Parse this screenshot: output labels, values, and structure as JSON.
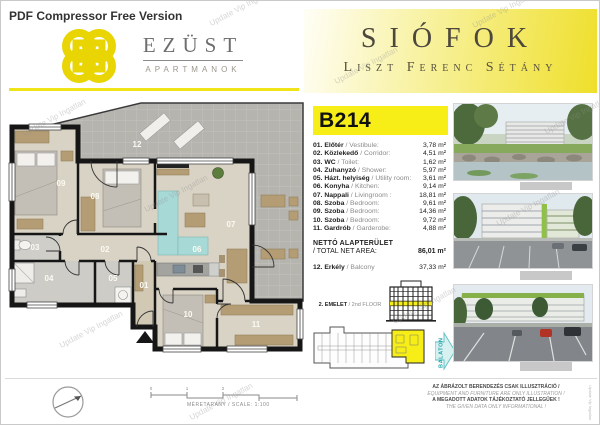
{
  "page": {
    "pdf_banner": "PDF Compressor Free Version",
    "watermark": "Update Vip Ingatlan"
  },
  "brand": {
    "name": "EZÜST",
    "subtitle": "APARTMANOK"
  },
  "location": {
    "city": "SIÓFOK",
    "street": "Liszt Ferenc Sétány"
  },
  "unit": {
    "id": "B214",
    "rooms": [
      {
        "num": "01.",
        "hu": " Előtér",
        "en": " / Vestibule:",
        "area": "3,78 m²"
      },
      {
        "num": "02.",
        "hu": " Közlekedő",
        "en": " / Corridor:",
        "area": "4,51 m²"
      },
      {
        "num": "03.",
        "hu": " WC",
        "en": " / Toilet:",
        "area": "1,62 m²"
      },
      {
        "num": "04.",
        "hu": " Zuhanyzó",
        "en": " / Shower:",
        "area": "5,97 m²"
      },
      {
        "num": "05.",
        "hu": " Házt. helyiség",
        "en": " / Utility room:",
        "area": "3,61 m²"
      },
      {
        "num": "06.",
        "hu": " Konyha",
        "en": " / Kitchen:",
        "area": "9,14 m²"
      },
      {
        "num": "07.",
        "hu": " Nappali",
        "en": " / Livingroom :",
        "area": "18,81 m²"
      },
      {
        "num": "08.",
        "hu": " Szoba",
        "en": " / Bedroom:",
        "area": "9,61 m²"
      },
      {
        "num": "09.",
        "hu": " Szoba",
        "en": " / Bedroom:",
        "area": "14,36 m²"
      },
      {
        "num": "10.",
        "hu": " Szoba",
        "en": " / Bedroom:",
        "area": "9,72 m²"
      },
      {
        "num": "11.",
        "hu": " Gardrób",
        "en": " / Garderobe:",
        "area": "4,88 m²"
      }
    ],
    "net": {
      "hu": "NETTÓ ALAPTERÜLET",
      "en": "/ TOTAL NET AREA:",
      "area": "86,01 m²"
    },
    "balcony": {
      "num": "12.",
      "hu": " Erkély",
      "en": " / Balcony",
      "area": "37,33 m²"
    },
    "floor": {
      "hu": "2. EMELET",
      "en": " / 2nd FLOOR"
    }
  },
  "plan": {
    "labels": {
      "r01": "01",
      "r02": "02",
      "r03": "03",
      "r04": "04",
      "r05": "05",
      "r06": "06",
      "r07": "07",
      "r08": "08",
      "r09": "09",
      "r10": "10",
      "r11": "11",
      "r12": "12"
    }
  },
  "direction": {
    "label": "BALATON"
  },
  "scale": {
    "ticks": [
      "0",
      "1",
      "2"
    ],
    "label": "MÉRETARÁNY / SCALE: 1:100"
  },
  "disclaimer": [
    "AZ ÁBRÁZOLT BERENDEZÉS CSAK ILLUSZTRÁCIÓ /",
    "EQUIPMENT AND FURNITURE ARE ONLY ILLUSTRATION !",
    "A MEGADOTT ADATOK TÁJÉKOZTATÓ JELLEGŰEK !",
    "THE GIVEN DATA ONLY INFORMATIONAL !"
  ],
  "colors": {
    "accent_yellow": "#f7ee17",
    "balcony_gray": "#b5b4af",
    "sofa_teal": "#a7d9d6",
    "wood_tan": "#b49d74",
    "balaton_teal": "#27a4a9"
  }
}
